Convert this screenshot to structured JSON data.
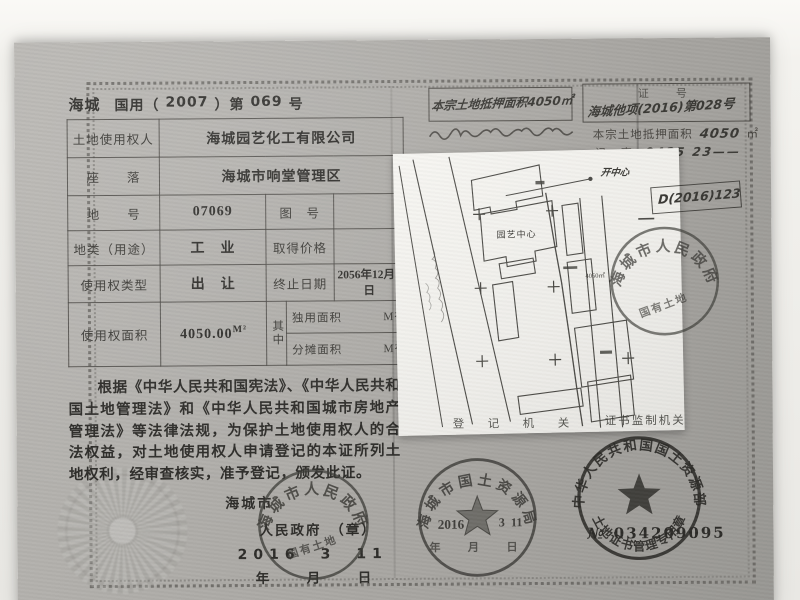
{
  "header": {
    "region": "海城",
    "form_left": "国用（",
    "year": "2007",
    "form_mid": "）第",
    "number": "069",
    "form_right": "号"
  },
  "table": {
    "row1": {
      "label": "土地使用权人",
      "value": "海城园艺化工有限公司"
    },
    "row2": {
      "label": "座　　落",
      "value": "海城市响堂管理区"
    },
    "row3": {
      "label": "地　　号",
      "value": "07069",
      "label2": "图　号",
      "value2": ""
    },
    "row4": {
      "label": "地类（用途）",
      "value": "工　业",
      "label2": "取得价格",
      "value2": ""
    },
    "row5": {
      "label": "使用权类型",
      "value": "出　让",
      "label2": "终止日期",
      "value2": "2056年12月2日"
    },
    "row6": {
      "label": "使用权面积",
      "value": "4050.00",
      "unit": "M²",
      "mid": "其中",
      "sub1": "独用面积",
      "sub1_unit": "M²",
      "sub2": "分摊面积",
      "sub2_unit": "M²"
    }
  },
  "body_text": "根据《中华人民共和国宪法》、《中华人民共和国土地管理法》和《中华人民共和国城市房地产管理法》等法律法规，为保护土地使用权人的合法权益，对土地使用权人申请登记的本证所列土地权利，经审查核实，准予登记，颁发此证。",
  "issuer": {
    "name_line1": "海城市",
    "name_line2": "人民政府　（章）",
    "stamp_date": "2016　3　11",
    "date_template": "年　月　日"
  },
  "annotations": {
    "mortgage_note": "本宗土地抵押面积4050㎡",
    "cert_no_label": "证　号",
    "cert_no_value": "海城他项(2016)第028号",
    "mortgage_area_label": "本宗土地抵押面积",
    "mortgage_area_value": "4050",
    "mortgage_area_unit": "㎡",
    "note_row_label": "记　事",
    "note_row_value": "0425 23——",
    "note_small": "开中心",
    "boxed_ref": "D(2016)123",
    "registry_label": "登　记　机　关",
    "supervisor_label": "证书监制机关"
  },
  "seals": {
    "government": {
      "arc_text": "海城市人民政府",
      "inner_text": "国有土地"
    },
    "land_bureau": {
      "arc_text": "海城市国土资源局",
      "stamp_year": "2016",
      "stamp_month": "3",
      "stamp_day": "11",
      "date_row": "年　月　日"
    },
    "ministry": {
      "arc_top": "中华人民共和国国土资源部",
      "arc_bottom": "土地证书管理专用章"
    },
    "serial": {
      "prefix": "№",
      "number": "034209095"
    }
  },
  "map": {
    "label_center": "园艺中心",
    "label_area": "4050㎡"
  }
}
